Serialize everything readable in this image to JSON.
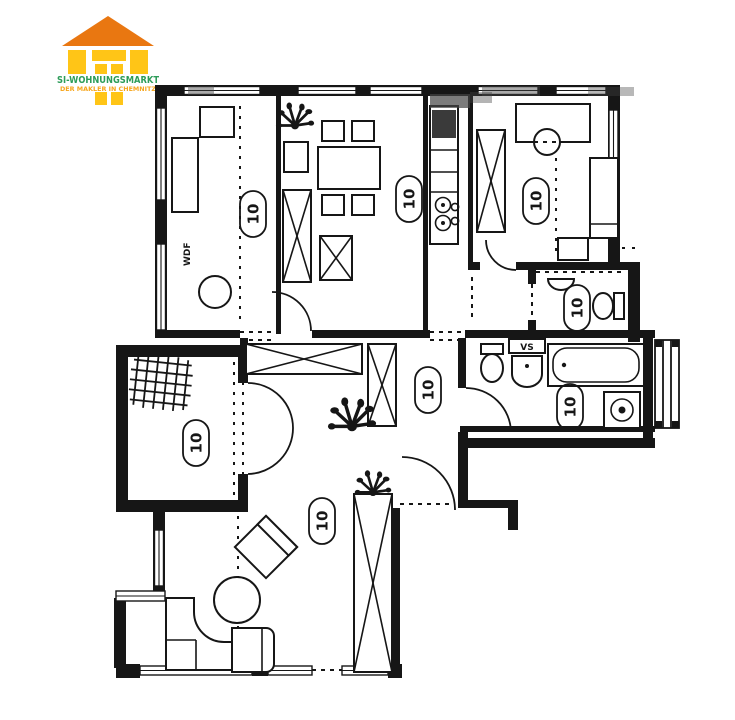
{
  "logo": {
    "title": "SI-WOHNUNGSMARKT",
    "subtitle": "DER MAKLER IN CHEMNITZ",
    "roof_color": "#E97711",
    "block_color": "#FFC517",
    "title_color": "#2D9C59",
    "subtitle_color": "#F6A51C"
  },
  "plan": {
    "ink_color": "#161616",
    "unit_label": "10",
    "labels": [
      {
        "room": "top-left-room",
        "text": "10"
      },
      {
        "room": "dining-room",
        "text": "10"
      },
      {
        "room": "bedroom",
        "text": "10"
      },
      {
        "room": "wc",
        "text": "10"
      },
      {
        "room": "hallway",
        "text": "10"
      },
      {
        "room": "bathroom",
        "text": "10"
      },
      {
        "room": "loggia",
        "text": "10"
      },
      {
        "room": "living-room",
        "text": "10"
      }
    ],
    "annotations": {
      "wall_note": "WDF",
      "shaft_note": "VS"
    }
  }
}
